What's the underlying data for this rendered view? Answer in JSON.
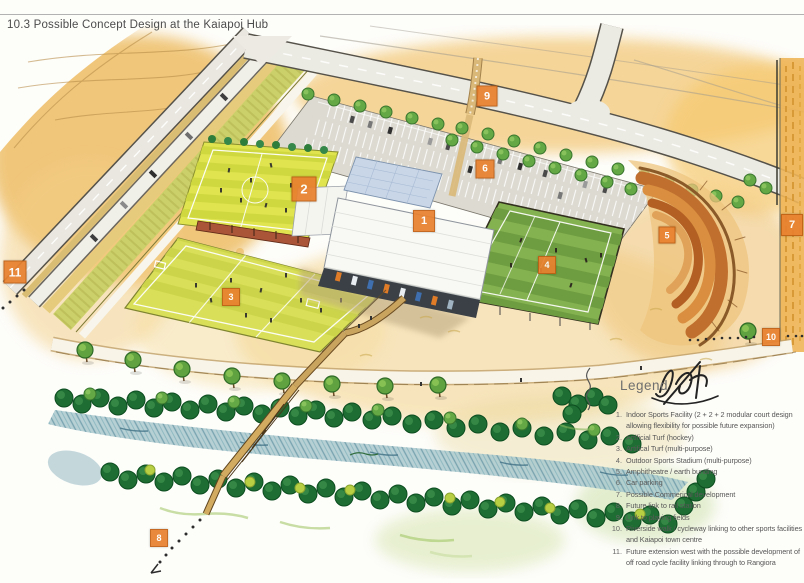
{
  "title": "10.3 Possible Concept Design at the Kaiapoi Hub",
  "legend": {
    "heading": "Legend",
    "items": [
      {
        "num": "1.",
        "text": "Indoor Sports Facility (2 + 2 + 2 modular court design allowing flexibility for possible future expansion)"
      },
      {
        "num": "2.",
        "text": "Artificial Turf (hockey)"
      },
      {
        "num": "3.",
        "text": "Artifical Turf (multi-purpose)"
      },
      {
        "num": "4.",
        "text": "Outdoor Sports Stadium (multi-purpose)"
      },
      {
        "num": "5.",
        "text": "Amphitheatre / earth bunding"
      },
      {
        "num": "6.",
        "text": "Car parking"
      },
      {
        "num": "7.",
        "text": "Possible Commerical development"
      },
      {
        "num": "8.",
        "text": "Future link to rail station"
      },
      {
        "num": "9.",
        "text": "Link to playing fields"
      },
      {
        "num": "10.",
        "text": "Riverside walk / cycleway linking to other sports facilities and Kaiapoi town centre"
      },
      {
        "num": "11.",
        "text": "Future extension west with the possible development of off road cycle facility linking through to Rangiora"
      }
    ]
  },
  "markers": [
    {
      "label": "1",
      "x": 424,
      "y": 221,
      "size": 20
    },
    {
      "label": "2",
      "x": 304,
      "y": 189,
      "size": 23
    },
    {
      "label": "3",
      "x": 231,
      "y": 297,
      "size": 16
    },
    {
      "label": "4",
      "x": 547,
      "y": 265,
      "size": 16
    },
    {
      "label": "5",
      "x": 667,
      "y": 235,
      "size": 15
    },
    {
      "label": "6",
      "x": 485,
      "y": 169,
      "size": 17
    },
    {
      "label": "7",
      "x": 792,
      "y": 225,
      "size": 20
    },
    {
      "label": "8",
      "x": 159,
      "y": 538,
      "size": 16
    },
    {
      "label": "9",
      "x": 487,
      "y": 96,
      "size": 19
    },
    {
      "label": "10",
      "x": 771,
      "y": 337,
      "size": 16
    },
    {
      "label": "11",
      "x": 15,
      "y": 272,
      "size": 21
    }
  ],
  "colors": {
    "marker_bg": "#e8812f",
    "marker_border": "#c05f14",
    "marker_text": "#ffffff",
    "title_text": "#4c4c4c",
    "legend_text": "#585858",
    "turf_yellow": "#dfe44f",
    "stadium_green": "#84b251",
    "water_teal": "#a9c8cd",
    "wash_amber": "#f0c26d"
  }
}
